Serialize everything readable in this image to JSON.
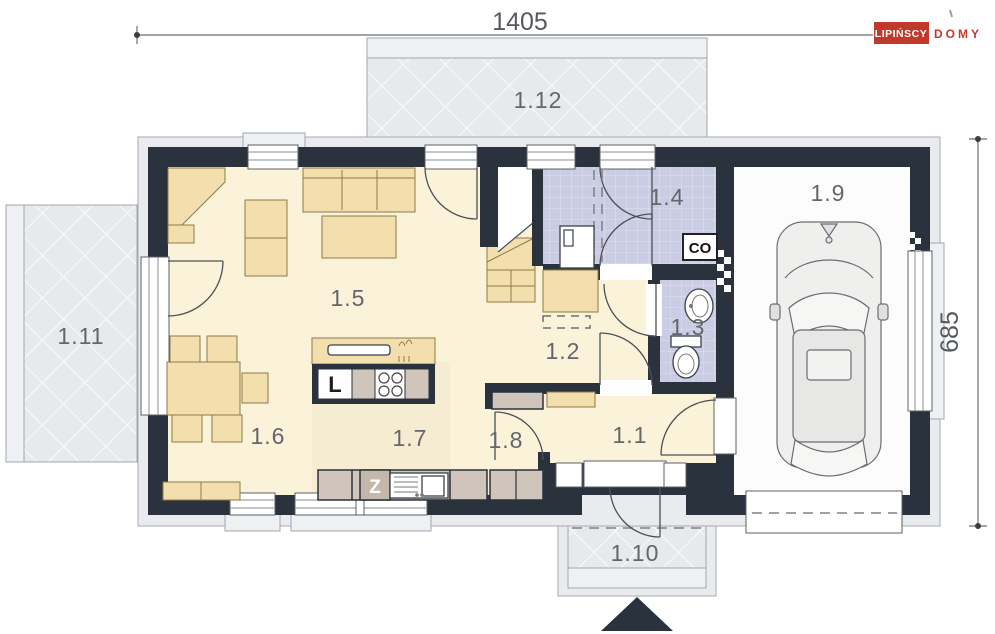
{
  "dimensions": {
    "width": "1405",
    "height": "685"
  },
  "logo": {
    "primary": "LIPIŃSCY",
    "secondary": "DOMY",
    "accent": "#c0392b"
  },
  "rooms": {
    "hall": {
      "label": "1.1"
    },
    "stair_hall": {
      "label": "1.2"
    },
    "wc": {
      "label": "1.3"
    },
    "utility": {
      "label": "1.4"
    },
    "living_room": {
      "label": "1.5"
    },
    "dining": {
      "label": "1.6"
    },
    "kitchen": {
      "label": "1.7"
    },
    "vestibule": {
      "label": "1.8"
    },
    "garage": {
      "label": "1.9"
    },
    "porch": {
      "label": "1.10"
    },
    "terrace_side": {
      "label": "1.11"
    },
    "terrace_back": {
      "label": "1.12"
    }
  },
  "annotations": {
    "boiler": "CO",
    "fridge": "L",
    "sink": "Z"
  },
  "colors": {
    "wall": "#2a323e",
    "floor": "#faf3da",
    "tiles": "#c9cce3",
    "terrace": "#e7e9ec",
    "furniture": "#f3dfae",
    "counter": "#cfc5bb",
    "accent": "#c0392b"
  }
}
